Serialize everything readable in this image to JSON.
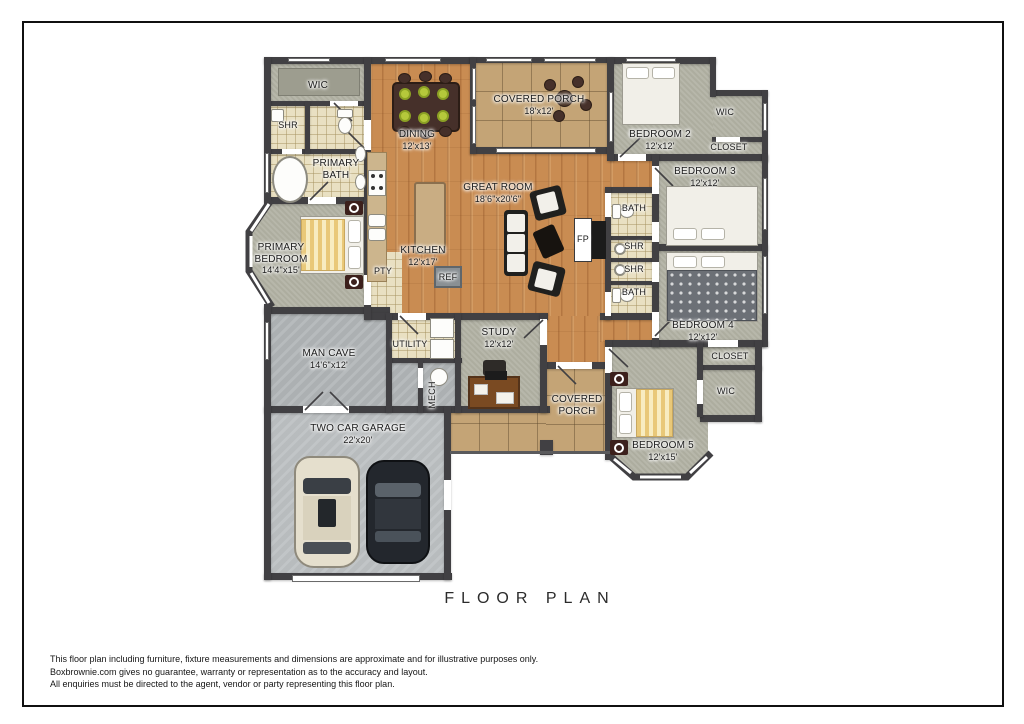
{
  "title": "FLOOR PLAN",
  "disclaimer": {
    "line1": "This floor plan including furniture, fixture measurements and dimensions are approximate and for illustrative purposes only.",
    "line2": "Boxbrownie.com gives no guarantee, warranty or representation as to the accuracy and layout.",
    "line3": "All enquiries must be directed to the agent, vendor or party representing this floor plan."
  },
  "rooms": {
    "wic_top": {
      "name": "WIC"
    },
    "shr_top": {
      "name": "SHR"
    },
    "primary_bath": {
      "name": "PRIMARY BATH"
    },
    "dining": {
      "name": "DINING",
      "dims": "12'x13'"
    },
    "covered_porch_top": {
      "name": "COVERED PORCH",
      "dims": "18'x12'"
    },
    "bedroom2": {
      "name": "BEDROOM 2",
      "dims": "12'x12'"
    },
    "wic_top_right": {
      "name": "WIC"
    },
    "closet_top_right": {
      "name": "CLOSET"
    },
    "bedroom3": {
      "name": "BEDROOM 3",
      "dims": "12'x12'"
    },
    "great_room": {
      "name": "GREAT ROOM",
      "dims": "18'6\"x20'6\""
    },
    "bath_upper": {
      "name": "BATH"
    },
    "shr_upper": {
      "name": "SHR"
    },
    "shr_lower": {
      "name": "SHR"
    },
    "bath_lower": {
      "name": "BATH"
    },
    "fireplace": {
      "name": "FP"
    },
    "bedroom4": {
      "name": "BEDROOM 4",
      "dims": "12'x12'"
    },
    "primary_bedroom": {
      "name": "PRIMARY BEDROOM",
      "dims": "14'4\"x15'"
    },
    "kitchen": {
      "name": "KITCHEN",
      "dims": "12'x17'"
    },
    "pantry": {
      "name": "PTY"
    },
    "fridge": {
      "name": "REF"
    },
    "man_cave": {
      "name": "MAN CAVE",
      "dims": "14'6\"x12'"
    },
    "utility": {
      "name": "UTILITY"
    },
    "mech": {
      "name": "MECH"
    },
    "study": {
      "name": "STUDY",
      "dims": "12'x12'"
    },
    "covered_porch_bottom": {
      "name": "COVERED PORCH"
    },
    "closet_bottom_right": {
      "name": "CLOSET"
    },
    "wic_bottom_right": {
      "name": "WIC"
    },
    "bedroom5": {
      "name": "BEDROOM 5",
      "dims": "12'x15'"
    },
    "garage": {
      "name": "TWO CAR GARAGE",
      "dims": "22'x20'"
    }
  },
  "colors": {
    "wall": "#414043",
    "wood_floor": "#c98c52",
    "carpet": "#b3b3a5",
    "bath_tile": "#e9e0c2",
    "porch_tile": "#c4a476",
    "concrete": "#bcc0c2",
    "accent_plate_green": "#b5c83b",
    "duvet_yellow": "#e9c878"
  }
}
